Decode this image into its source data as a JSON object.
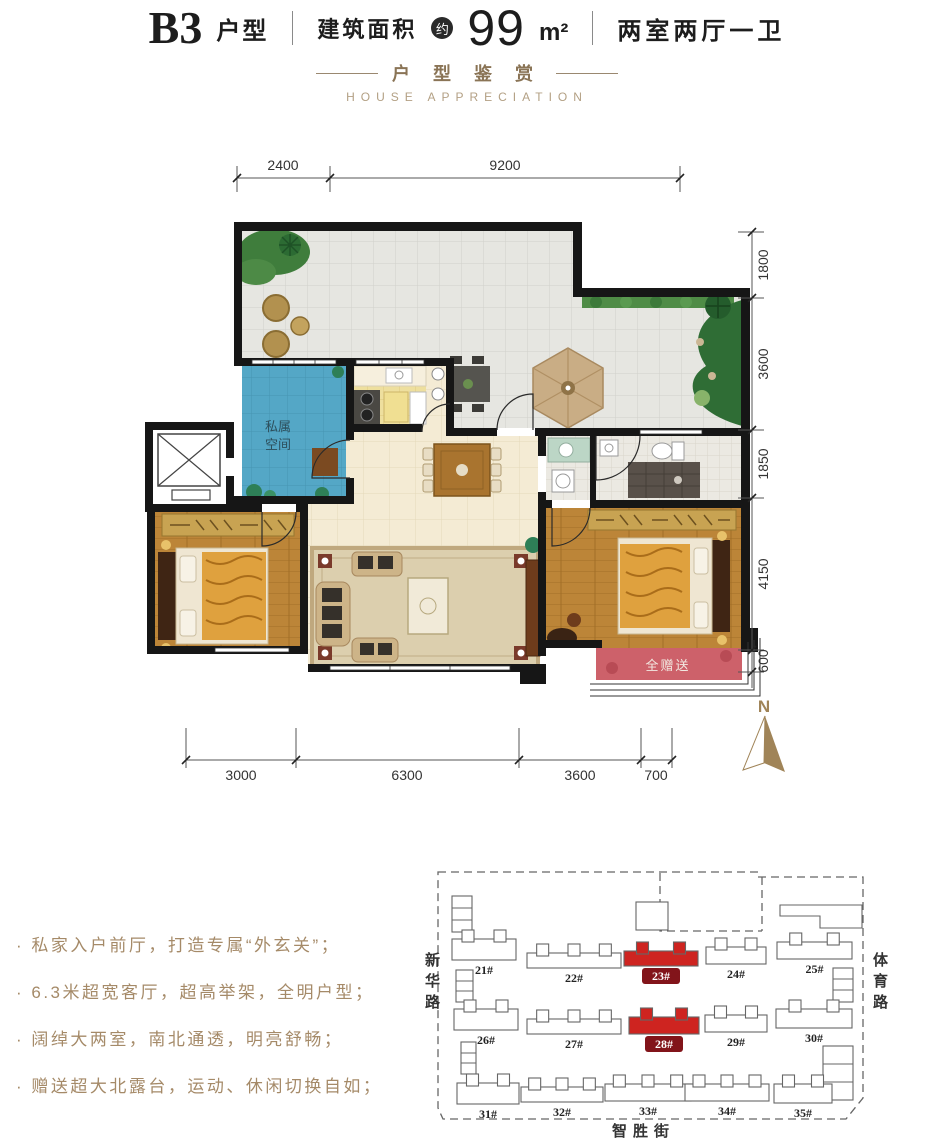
{
  "header": {
    "plan_code": "B3",
    "plan_code_suffix": "户型",
    "area_label": "建筑面积",
    "area_circle": "约",
    "area_value": "99",
    "area_unit": "m²",
    "layout_text": "两室两厅一卫"
  },
  "section": {
    "title_cn": "户 型 鉴 赏",
    "title_en": "HOUSE APPRECIATION"
  },
  "plan": {
    "north_label": "N",
    "room_labels": {
      "foyer_line1": "私属",
      "foyer_line2": "空间",
      "bay_window": "全赠送"
    },
    "dims_top": [
      "2400",
      "9200"
    ],
    "dims_right": [
      "1800",
      "3600",
      "1850",
      "4150",
      "600"
    ],
    "dims_bottom": [
      "3000",
      "6300",
      "3600",
      "700"
    ]
  },
  "features": {
    "items": [
      "· 私家入户前厅，打造专属“外玄关”；",
      "· 6.3米超宽客厅，超高举架，全明户型；",
      "· 阔绰大两室，南北通透，明亮舒畅；",
      "· 赠送超大北露台，运动、休闲切换自如；"
    ]
  },
  "site_plan": {
    "streets": {
      "left": "新华路",
      "right": "体育路",
      "bottom": "智胜街"
    },
    "highlight_color": "#ce2420",
    "chip_color": "#82141a",
    "buildings": [
      {
        "label": "21#",
        "x": 452,
        "y": 930,
        "w": 64,
        "h": 30,
        "highlighted": false
      },
      {
        "label": "22#",
        "x": 527,
        "y": 944,
        "w": 94,
        "h": 24,
        "highlighted": false
      },
      {
        "label": "23#",
        "x": 624,
        "y": 942,
        "w": 74,
        "h": 24,
        "highlighted": true
      },
      {
        "label": "24#",
        "x": 706,
        "y": 938,
        "w": 60,
        "h": 26,
        "highlighted": false
      },
      {
        "label": "25#",
        "x": 777,
        "y": 933,
        "w": 75,
        "h": 26,
        "highlighted": false
      },
      {
        "label": "26#",
        "x": 454,
        "y": 1000,
        "w": 64,
        "h": 30,
        "highlighted": false
      },
      {
        "label": "27#",
        "x": 527,
        "y": 1010,
        "w": 94,
        "h": 24,
        "highlighted": false
      },
      {
        "label": "28#",
        "x": 629,
        "y": 1008,
        "w": 70,
        "h": 26,
        "highlighted": true
      },
      {
        "label": "29#",
        "x": 705,
        "y": 1006,
        "w": 62,
        "h": 26,
        "highlighted": false
      },
      {
        "label": "30#",
        "x": 776,
        "y": 1000,
        "w": 76,
        "h": 28,
        "highlighted": false
      },
      {
        "label": "31#",
        "x": 457,
        "y": 1074,
        "w": 62,
        "h": 30,
        "highlighted": false
      },
      {
        "label": "32#",
        "x": 521,
        "y": 1078,
        "w": 82,
        "h": 24,
        "highlighted": false
      },
      {
        "label": "33#",
        "x": 605,
        "y": 1075,
        "w": 86,
        "h": 26,
        "highlighted": false
      },
      {
        "label": "34#",
        "x": 685,
        "y": 1075,
        "w": 84,
        "h": 26,
        "highlighted": false
      },
      {
        "label": "35#",
        "x": 774,
        "y": 1075,
        "w": 58,
        "h": 28,
        "highlighted": false
      }
    ]
  }
}
